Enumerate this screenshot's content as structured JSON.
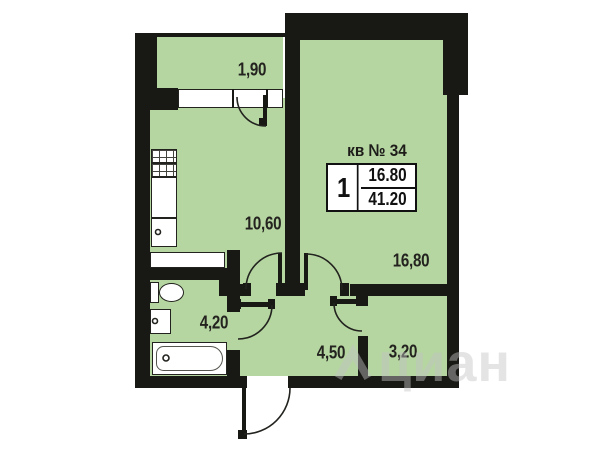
{
  "plan": {
    "apartment_label": "кв № 34",
    "summary": {
      "rooms": "1",
      "living_area": "16.80",
      "total_area": "41.20"
    },
    "rooms": [
      {
        "id": "balcony",
        "area_label": "1,90"
      },
      {
        "id": "kitchen",
        "area_label": "10,60"
      },
      {
        "id": "living-room",
        "area_label": "16,80"
      },
      {
        "id": "bathroom",
        "area_label": "4,20"
      },
      {
        "id": "hallway",
        "area_label": "4,50"
      },
      {
        "id": "storage",
        "area_label": "3,20"
      }
    ],
    "fixtures": [
      "stove-icon",
      "kitchen-sink-icon",
      "counter-icon",
      "toilet-icon",
      "washbasin-icon",
      "bathtub-icon"
    ],
    "openings": [
      "window",
      "balcony-door",
      "kitchen-door",
      "living-room-door",
      "bathroom-door",
      "storage-door",
      "entry-door"
    ],
    "colors": {
      "room_fill": "#b5d6a1",
      "wall": "#181815",
      "background": "#ffffff",
      "label_text": "#24231f",
      "watermark": "#e9e9e9"
    },
    "watermark": {
      "text": "циан"
    }
  }
}
